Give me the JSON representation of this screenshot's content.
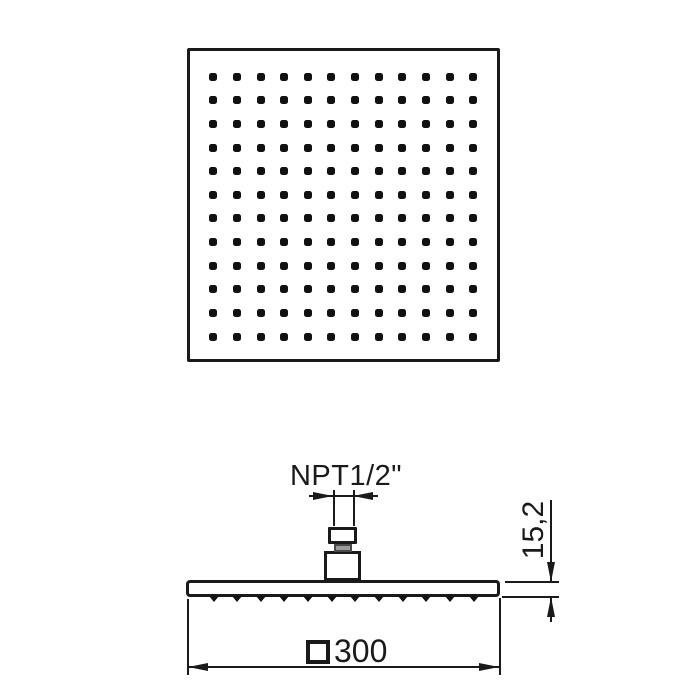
{
  "drawing": {
    "description": "Technical drawing of a square overhead rain shower head, top view and side view",
    "colors": {
      "line": "#1a1a1a",
      "background": "#ffffff",
      "neck_gray": "#9b9b9b"
    },
    "top_view": {
      "spray_dot_rows": 12,
      "spray_dot_cols": 12
    },
    "side_view": {
      "nozzle_count": 12,
      "connection_label": "NPT1/2\"",
      "thickness_dim_label": "15,2",
      "width_dim_symbol": "□",
      "width_dim_value": "300"
    }
  }
}
